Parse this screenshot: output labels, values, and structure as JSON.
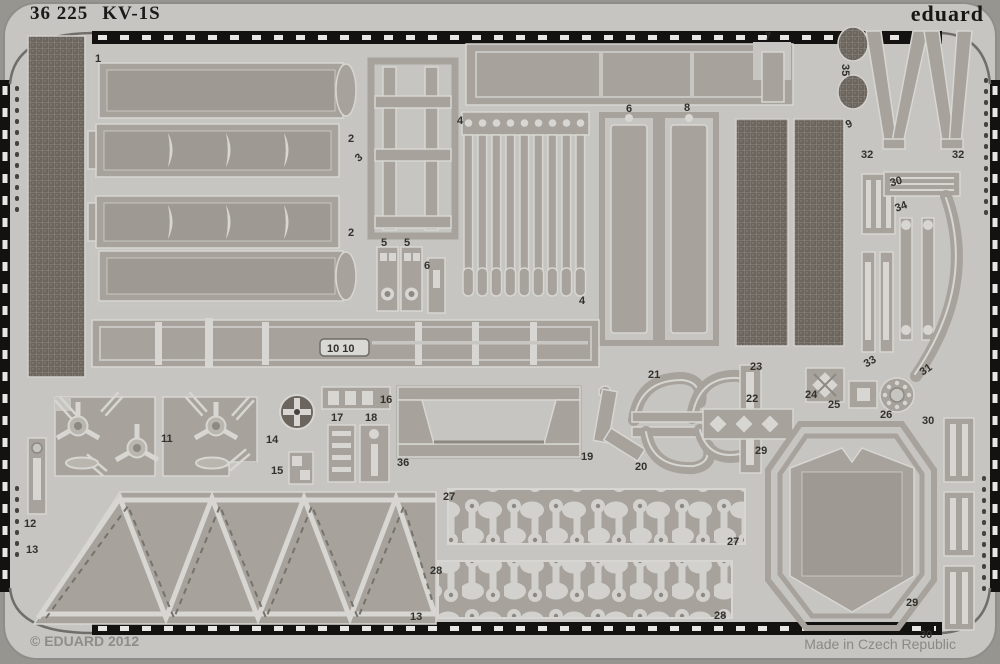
{
  "header": {
    "catalog_number": "36 225",
    "kit_name": "KV-1S",
    "brand": "eduard"
  },
  "footer": {
    "copyright": "© EDUARD 2012",
    "origin": "Made in Czech Republic"
  },
  "colors": {
    "background": "#97958f",
    "sheet": "#c6c5c1",
    "part_metal": "#a7a39c",
    "etch_highlight": "#d7d6d2",
    "mesh_dark": "#6b655e",
    "film_edge_black": "#131210",
    "label_text": "#33312d",
    "footer_text": "#8e8d89"
  },
  "part_labels": [
    {
      "t": "1"
    },
    {
      "t": "2"
    },
    {
      "t": "3"
    },
    {
      "t": "2"
    },
    {
      "t": "5"
    },
    {
      "t": "5"
    },
    {
      "t": "6"
    },
    {
      "t": "4"
    },
    {
      "t": "4"
    },
    {
      "t": "7"
    },
    {
      "t": "6"
    },
    {
      "t": "8"
    },
    {
      "t": "35"
    },
    {
      "t": "9"
    },
    {
      "t": "32"
    },
    {
      "t": "32"
    },
    {
      "t": "30"
    },
    {
      "t": "34"
    },
    {
      "t": "33"
    },
    {
      "t": "31"
    },
    {
      "t": "10 10"
    },
    {
      "t": "16"
    },
    {
      "t": "17"
    },
    {
      "t": "18"
    },
    {
      "t": "36"
    },
    {
      "t": "14"
    },
    {
      "t": "15"
    },
    {
      "t": "11"
    },
    {
      "t": "12"
    },
    {
      "t": "13"
    },
    {
      "t": "13"
    },
    {
      "t": "19"
    },
    {
      "t": "21"
    },
    {
      "t": "20"
    },
    {
      "t": "23"
    },
    {
      "t": "22"
    },
    {
      "t": "24"
    },
    {
      "t": "25"
    },
    {
      "t": "26"
    },
    {
      "t": "29"
    },
    {
      "t": "29"
    },
    {
      "t": "27"
    },
    {
      "t": "27"
    },
    {
      "t": "28"
    },
    {
      "t": "28"
    },
    {
      "t": "30"
    },
    {
      "t": "30"
    }
  ]
}
